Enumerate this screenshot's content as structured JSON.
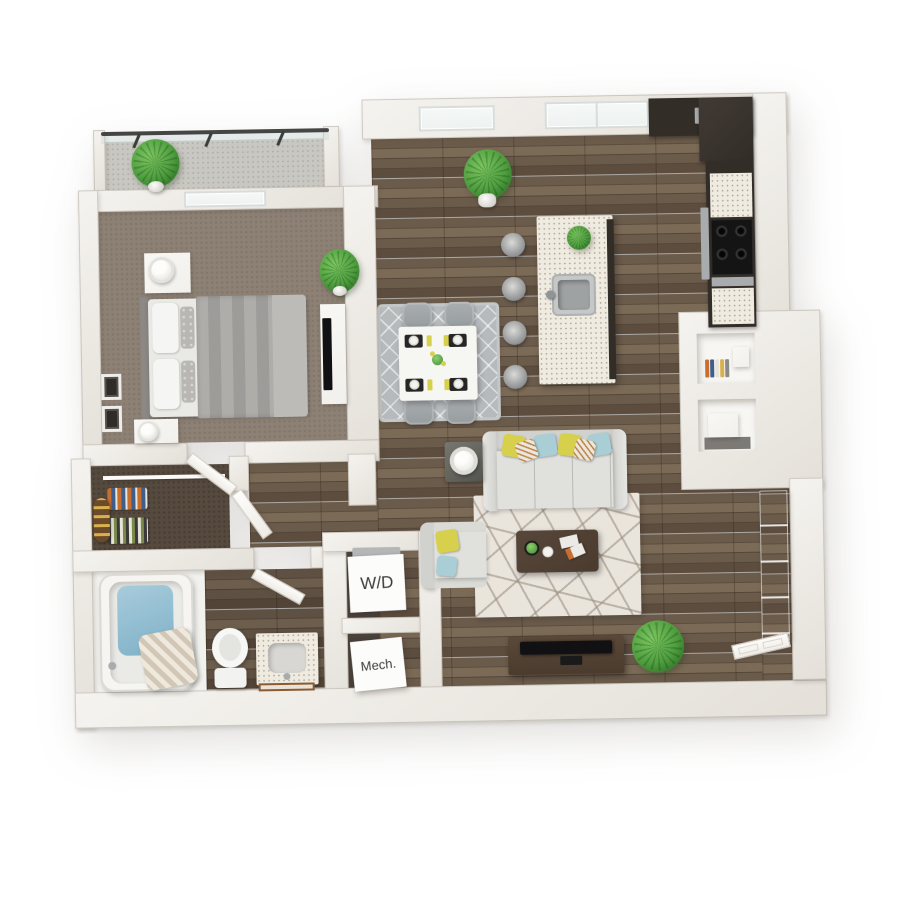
{
  "document": {
    "type": "3D apartment floor plan",
    "view": "top-down 3D render",
    "background": "#ffffff"
  },
  "labels": {
    "washer_dryer": "W/D",
    "mechanical": "Mech."
  },
  "palette": {
    "wall-a": "#f5f3ef",
    "wall-b": "#e4e0d9",
    "wall-edge": "rgba(130,120,105,0.32)",
    "wood-a": "#6b5b4b",
    "wood-b": "#5d4d3e",
    "wood-c": "#7b6a56",
    "wood-d": "#544638",
    "wood-seam": "rgba(30,22,14,0.28)",
    "carpet-bedroom": "#8d8175",
    "carpet-closet": "#564a3e",
    "cell-floor": "#48413a",
    "balcony-floor": "#c8c7c1",
    "glass": "#edf1f0",
    "quartz": "#f0ebe0",
    "cabinet-dark": "#332d28",
    "cooktop": "#141414",
    "stainless": "#a9acae",
    "sofa-light": "#e0e0dd",
    "sofa-mid": "#d1d1ce",
    "rug-living": "#e9e4dc",
    "rug-line": "rgba(150,138,124,0.55)",
    "rug-dining": "#b6babc",
    "table-white": "#f6f6f3",
    "chair-gray": "#979c9e",
    "bed-duvet": "#a8a6a3",
    "bed-throw": "#bdbbb7",
    "headboard": "#8b8885",
    "pillow-yellow": "#d7d04c",
    "pillow-teal": "#a9ced5",
    "pillow-stripe": "#ece7dd",
    "pillow-stripe-line": "#bd8448",
    "plant-light": "#7cc661",
    "plant-green": "#4d9c3e",
    "plant-dark": "#2f6e27",
    "tub-blue-a": "#a7cbdc",
    "tub-blue-b": "#7fb0c7",
    "curtain-a": "#d2c7b6",
    "curtain-b": "#efe9dd",
    "walnut": "#4b3b2e",
    "tv-black": "#111113",
    "label-bg": "#fcfcfb",
    "label-text": "#3b3b3b",
    "mirror-a": "#d2d6d7",
    "mirror-b": "#a9afb1",
    "white-furn": "#f1f0ec",
    "mat-black": "#262626",
    "plate-white": "#f2f2ef",
    "book-1": "#c96f2e",
    "book-2": "#3f5f8a",
    "book-3": "#d8b14e"
  },
  "rooms": [
    {
      "id": "balcony",
      "items": [
        "glass-railing",
        "potted-plant"
      ]
    },
    {
      "id": "bedroom",
      "items": [
        "bed",
        "nightstands",
        "table-lamps",
        "dresser",
        "tv",
        "potted-plant",
        "wall-art",
        "window"
      ]
    },
    {
      "id": "walk-in-closet",
      "items": [
        "hanging-clothes",
        "rolled-rug",
        "shelf"
      ]
    },
    {
      "id": "bathroom",
      "items": [
        "bathtub",
        "shower-curtain",
        "toilet",
        "vanity-sink",
        "bath-mat"
      ]
    },
    {
      "id": "laundry-closet",
      "label_ref": "washer_dryer",
      "items": [
        "washer-dryer-unit"
      ]
    },
    {
      "id": "mechanical-closet",
      "label_ref": "mechanical",
      "items": [
        "mechanical-unit"
      ]
    },
    {
      "id": "kitchen",
      "items": [
        "island-with-sink",
        "bar-stools",
        "cooktop",
        "oven",
        "refrigerator",
        "dark-cabinets",
        "window",
        "plant"
      ]
    },
    {
      "id": "dining-area",
      "items": [
        "dining-table",
        "four-chairs",
        "place-settings",
        "diamond-rug"
      ]
    },
    {
      "id": "living-room",
      "items": [
        "sofa",
        "throw-pillows",
        "armchair",
        "side-table-lamp",
        "coffee-table",
        "geometric-rug",
        "tv-console",
        "tv",
        "potted-plants"
      ]
    },
    {
      "id": "entry",
      "items": [
        "front-door",
        "display-shelves",
        "glass-shelf-unit"
      ]
    }
  ]
}
